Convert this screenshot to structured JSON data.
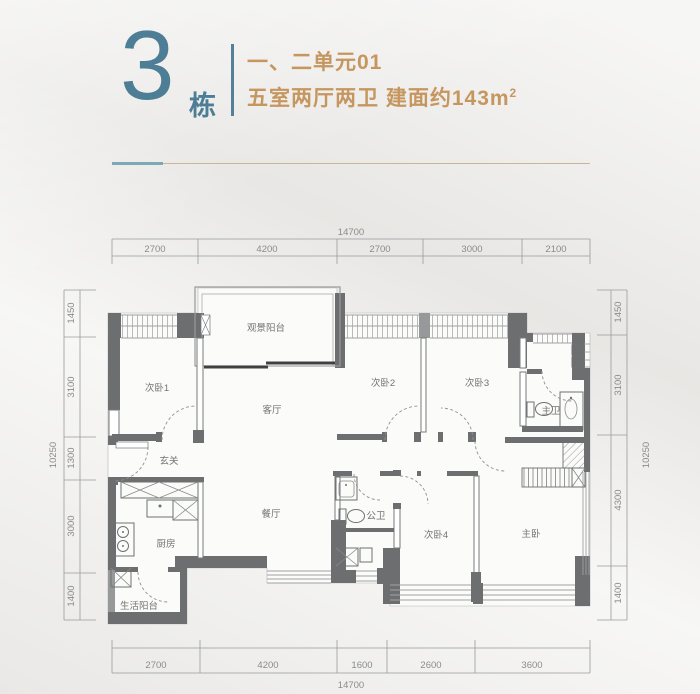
{
  "header": {
    "building_number": "3",
    "building_suffix": "栋",
    "unit_line": "一、二单元01",
    "layout_line": "五室两厅两卫 建面约143m",
    "area_superscript": "2"
  },
  "colors": {
    "teal_accent": "#4e7e95",
    "tan_text": "#c6965f",
    "wall_gray": "#6d6e70",
    "separator_tan": "#c9b695"
  },
  "floorplan": {
    "rooms": [
      {
        "id": "view-balcony",
        "label": "观景阳台"
      },
      {
        "id": "bedroom-1",
        "label": "次卧1"
      },
      {
        "id": "bedroom-2",
        "label": "次卧2"
      },
      {
        "id": "bedroom-3",
        "label": "次卧3"
      },
      {
        "id": "master-bath",
        "label": "主卫"
      },
      {
        "id": "living-room",
        "label": "客厅"
      },
      {
        "id": "entryway",
        "label": "玄关"
      },
      {
        "id": "dining-room",
        "label": "餐厅"
      },
      {
        "id": "public-bath",
        "label": "公卫"
      },
      {
        "id": "bedroom-4",
        "label": "次卧4"
      },
      {
        "id": "master-bedroom",
        "label": "主卧"
      },
      {
        "id": "kitchen",
        "label": "厨房"
      },
      {
        "id": "service-balcony",
        "label": "生活阳台"
      }
    ],
    "dims": {
      "top": {
        "total": "14700",
        "segments": [
          "2700",
          "4200",
          "2700",
          "3000",
          "2100"
        ]
      },
      "bottom": {
        "total": "14700",
        "segments": [
          "2700",
          "4200",
          "1600",
          "2600",
          "3600"
        ]
      },
      "left": {
        "total": "10250",
        "segments": [
          "1450",
          "3100",
          "1300",
          "3000",
          "1400"
        ]
      },
      "right": {
        "total": "10250",
        "segments": [
          "1450",
          "3100",
          "4300",
          "1400"
        ]
      }
    }
  }
}
